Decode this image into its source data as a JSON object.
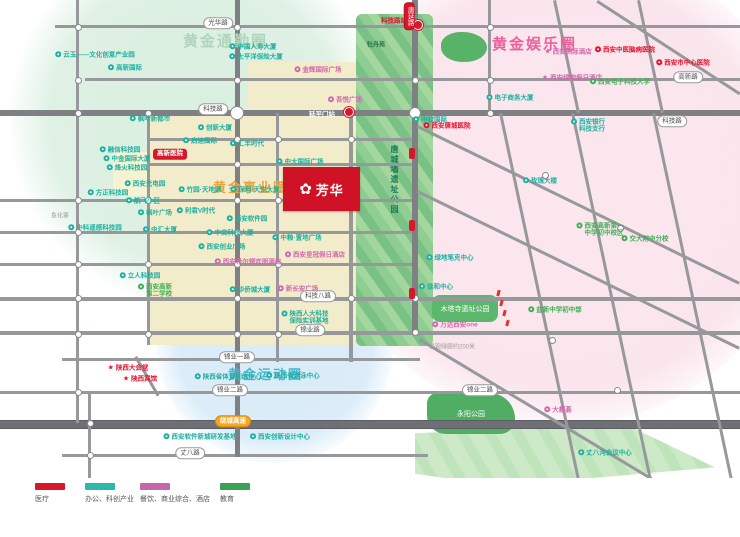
{
  "zones": {
    "commute": {
      "label": "黄金通勤圈",
      "color": "#a9d4b8"
    },
    "entertainment": {
      "label": "黄金娱乐圈",
      "color": "#ee5f9e"
    },
    "career": {
      "label": "黄金事业圈",
      "color": "#e9a43c"
    },
    "sport": {
      "label": "黄金运动圈",
      "color": "#45b4d2"
    }
  },
  "logo": {
    "name": "芳华",
    "flower_icon": "✿",
    "bg": "#cf1225"
  },
  "legend": [
    {
      "label": "医疗",
      "color": "#d7182a",
      "x": 35
    },
    {
      "label": "办公、科创产业",
      "color": "#2cb9aa",
      "x": 85
    },
    {
      "label": "餐饮、商业综合、酒店",
      "color": "#c667a9",
      "x": 140
    },
    {
      "label": "教育",
      "color": "#3aa254",
      "x": 220
    }
  ],
  "metro": {
    "station_north": "科技路站",
    "station_on_road": "延平门站"
  },
  "parks": [
    {
      "name": "牡丹苑"
    },
    {
      "name": "唐城墙遗址公园"
    },
    {
      "name": "木塔寺遗址公园"
    },
    {
      "name": "永阳公园"
    }
  ],
  "road_pills": [
    {
      "x": 218,
      "y": 23,
      "text": "光华路",
      "type": "white"
    },
    {
      "x": 688,
      "y": 77,
      "text": "高新路",
      "type": "white"
    },
    {
      "x": 213,
      "y": 109,
      "text": "科技路",
      "type": "white"
    },
    {
      "x": 672,
      "y": 121,
      "text": "科技路",
      "type": "white"
    },
    {
      "x": 318,
      "y": 296,
      "text": "科技八路",
      "type": "white"
    },
    {
      "x": 310,
      "y": 330,
      "text": "锦业路",
      "type": "white"
    },
    {
      "x": 237,
      "y": 357,
      "text": "锦业一路",
      "type": "white"
    },
    {
      "x": 230,
      "y": 390,
      "text": "锦业二路",
      "type": "white"
    },
    {
      "x": 480,
      "y": 390,
      "text": "锦业二路",
      "type": "white"
    },
    {
      "x": 233,
      "y": 421,
      "text": "绕城高速",
      "type": "orange"
    },
    {
      "x": 190,
      "y": 453,
      "text": "丈八路",
      "type": "white"
    },
    {
      "x": 409,
      "y": 16,
      "text": "唐延路",
      "type": "redv"
    }
  ],
  "gray_texts": [
    {
      "x": 60,
      "y": 215,
      "text": "鱼化寨"
    },
    {
      "x": 452,
      "y": 346,
      "text": "景观绿廊约200米"
    }
  ],
  "pois": [
    {
      "x": 95,
      "y": 55,
      "cat": "office",
      "text": "云玉——文化创意产业园"
    },
    {
      "x": 125,
      "y": 68,
      "cat": "office",
      "text": "高新国际"
    },
    {
      "x": 253,
      "y": 47,
      "cat": "office",
      "text": "中国人寿大厦"
    },
    {
      "x": 256,
      "y": 57,
      "cat": "office",
      "text": "太平洋保险大厦"
    },
    {
      "x": 318,
      "y": 70,
      "cat": "commerce",
      "text": "金辉国际广场"
    },
    {
      "x": 345,
      "y": 100,
      "cat": "commerce",
      "text": "吾悦广场"
    },
    {
      "x": 150,
      "y": 119,
      "cat": "office",
      "text": "枫叶新都市"
    },
    {
      "x": 215,
      "y": 128,
      "cat": "office",
      "text": "创新大厦"
    },
    {
      "x": 200,
      "y": 141,
      "cat": "office",
      "text": "启迪国际"
    },
    {
      "x": 247,
      "y": 144,
      "cat": "office",
      "text": "汇丰时代"
    },
    {
      "x": 120,
      "y": 150,
      "cat": "office",
      "text": "融信科技园"
    },
    {
      "x": 127,
      "y": 159,
      "cat": "office",
      "text": "中金国际大厦"
    },
    {
      "x": 127,
      "y": 168,
      "cat": "office",
      "text": "烽火科技园"
    },
    {
      "x": 145,
      "y": 184,
      "cat": "office",
      "text": "西安光电园"
    },
    {
      "x": 108,
      "y": 193,
      "cat": "office",
      "text": "方正科技园"
    },
    {
      "x": 143,
      "y": 201,
      "cat": "office",
      "text": "航飞小区"
    },
    {
      "x": 155,
      "y": 213,
      "cat": "office",
      "text": "枫叶广场"
    },
    {
      "x": 95,
      "y": 228,
      "cat": "office",
      "text": "中科遥感科技园"
    },
    {
      "x": 160,
      "y": 230,
      "cat": "office",
      "text": "中汇大厦"
    },
    {
      "x": 200,
      "y": 190,
      "cat": "office",
      "text": "竹园·天地源"
    },
    {
      "x": 255,
      "y": 190,
      "cat": "office",
      "text": "保利·天悦大厦"
    },
    {
      "x": 196,
      "y": 211,
      "cat": "office",
      "text": "利君V时代"
    },
    {
      "x": 247,
      "y": 219,
      "cat": "office",
      "text": "西安软件园"
    },
    {
      "x": 230,
      "y": 233,
      "cat": "office",
      "text": "中交科技大厦"
    },
    {
      "x": 222,
      "y": 247,
      "cat": "office",
      "text": "西安创业广场"
    },
    {
      "x": 300,
      "y": 162,
      "cat": "office",
      "text": "中大国际广场"
    },
    {
      "x": 308,
      "y": 190,
      "cat": "office",
      "text": "泰华·龙旗国际"
    },
    {
      "x": 308,
      "y": 200,
      "cat": "office",
      "text": "唐沣国际广场"
    },
    {
      "x": 297,
      "y": 238,
      "cat": "office",
      "text": "中粮·置地广场"
    },
    {
      "x": 248,
      "y": 262,
      "cat": "commerce",
      "text": "西安希尔顿欢朋酒店"
    },
    {
      "x": 315,
      "y": 255,
      "cat": "commerce",
      "text": "西安皇冠假日酒店"
    },
    {
      "x": 298,
      "y": 289,
      "cat": "commerce",
      "text": "新长安广场"
    },
    {
      "x": 250,
      "y": 290,
      "cat": "office",
      "text": "华侨城大厦"
    },
    {
      "x": 140,
      "y": 276,
      "cat": "office",
      "text": "立人科技园"
    },
    {
      "x": 155,
      "y": 291,
      "cat": "education",
      "text": "西安高新\n第二学校"
    },
    {
      "x": 305,
      "y": 318,
      "cat": "office",
      "text": "陕西人大科技\n保险实训基地"
    },
    {
      "x": 430,
      "y": 120,
      "cat": "office",
      "text": "中软国际"
    },
    {
      "x": 510,
      "y": 98,
      "cat": "office",
      "text": "电子商务大厦"
    },
    {
      "x": 588,
      "y": 126,
      "cat": "office",
      "text": "西安银行\n科技支行"
    },
    {
      "x": 540,
      "y": 181,
      "cat": "office",
      "text": "玫瑰大楼"
    },
    {
      "x": 450,
      "y": 258,
      "cat": "office",
      "text": "绿地笔克中心"
    },
    {
      "x": 436,
      "y": 287,
      "cat": "office",
      "text": "佳和中心"
    },
    {
      "x": 568,
      "y": 52,
      "cat": "commerce",
      "text": "西安洲际酒店",
      "star": true
    },
    {
      "x": 572,
      "y": 78,
      "cat": "commerce",
      "text": "西安绿地假日酒店",
      "star": true
    },
    {
      "x": 625,
      "y": 50,
      "cat": "medical",
      "text": "西安中医脑病医院"
    },
    {
      "x": 683,
      "y": 63,
      "cat": "medical",
      "text": "西安市中心医院"
    },
    {
      "x": 447,
      "y": 126,
      "cat": "medical",
      "text": "西安唐城医院"
    },
    {
      "x": 620,
      "y": 82,
      "cat": "education",
      "text": "西安电子科技大学"
    },
    {
      "x": 600,
      "y": 230,
      "cat": "education",
      "text": "西安高新第一\n中学初中校区"
    },
    {
      "x": 645,
      "y": 239,
      "cat": "education",
      "text": "交大附中分校"
    },
    {
      "x": 555,
      "y": 310,
      "cat": "education",
      "text": "益新中学初中部"
    },
    {
      "x": 455,
      "y": 325,
      "cat": "commerce",
      "text": "万达西安one"
    },
    {
      "x": 558,
      "y": 410,
      "cat": "commerce",
      "text": "大都荟"
    },
    {
      "x": 128,
      "y": 368,
      "cat": "medical",
      "text": "陕西大会堂",
      "star": true
    },
    {
      "x": 140,
      "y": 379,
      "cat": "medical",
      "text": "陕西宾馆",
      "star": true
    },
    {
      "x": 228,
      "y": 377,
      "cat": "office",
      "text": "陕西省体育训练中心"
    },
    {
      "x": 293,
      "y": 376,
      "cat": "office",
      "text": "陕西省游泳中心"
    },
    {
      "x": 200,
      "y": 437,
      "cat": "office",
      "text": "西安软件新城研发基地"
    },
    {
      "x": 280,
      "y": 437,
      "cat": "office",
      "text": "西安创新设计中心"
    },
    {
      "x": 605,
      "y": 453,
      "cat": "office",
      "text": "丈八沟会议中心"
    }
  ],
  "colors": {
    "office": "#1fb0a0",
    "commerce": "#d368ae",
    "medical": "#e8112d",
    "education": "#3fae56"
  }
}
